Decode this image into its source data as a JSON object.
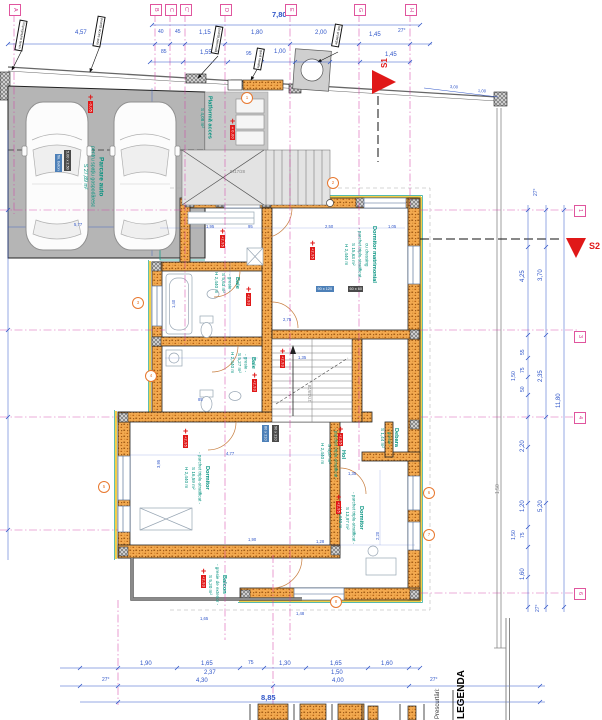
{
  "sections": {
    "s1": "S1",
    "s2": "S2"
  },
  "legend": {
    "title": "LEGENDA",
    "subtitle": "Prescurtări:"
  },
  "grid": {
    "top": [
      {
        "l": "A",
        "x": 14
      },
      {
        "l": "B",
        "x": 155
      },
      {
        "l": "C",
        "x": 170
      },
      {
        "l": "C'",
        "x": 185
      },
      {
        "l": "D",
        "x": 225
      },
      {
        "l": "E",
        "x": 290
      },
      {
        "l": "G",
        "x": 359
      },
      {
        "l": "H",
        "x": 410
      }
    ],
    "right": [
      {
        "l": "1",
        "y": 210
      },
      {
        "l": "3",
        "y": 336
      },
      {
        "l": "4",
        "y": 417
      },
      {
        "l": "6",
        "y": 593
      }
    ]
  },
  "rooms": [
    {
      "n": "master-bedroom",
      "x": 342,
      "y": 226,
      "cls": "",
      "lines": [
        "Dormitor matrimonial",
        "cu dressing",
        "- parchet triplu-stratificat -",
        "S 15,63 m²",
        "H 2,440 m"
      ]
    },
    {
      "n": "bathroom-1",
      "x": 212,
      "y": 272,
      "cls": "",
      "lines": [
        "Baie",
        "- gresie -",
        "S 5,63 m²",
        "H 2,440 m"
      ]
    },
    {
      "n": "bathroom-2",
      "x": 228,
      "y": 352,
      "cls": "",
      "lines": [
        "Baie",
        "- gresie -",
        "S 5,27 m²",
        "H 2,440 m"
      ]
    },
    {
      "n": "bedroom-1",
      "x": 182,
      "y": 452,
      "cls": "",
      "lines": [
        "Dormitor",
        "- parchet triplu-stratificat -",
        "S 16,59 m²",
        "H 2,440 m"
      ]
    },
    {
      "n": "bedroom-2",
      "x": 336,
      "y": 492,
      "cls": "",
      "lines": [
        "Dormitor",
        "- parchet triplu-stratificat -",
        "S 13,97 m²",
        "H 2,440 m"
      ]
    },
    {
      "n": "hallway",
      "x": 318,
      "y": 428,
      "cls": "",
      "lines": [
        "Hol",
        "- parchet triplu-stratificat -",
        "S 4,37 m²",
        "H 2,440 m"
      ]
    },
    {
      "n": "storage",
      "x": 378,
      "y": 428,
      "cls": "",
      "lines": [
        "Debara",
        "- gresie -",
        "S 1,44 m²"
      ]
    },
    {
      "n": "balcony",
      "x": 206,
      "y": 564,
      "cls": "",
      "lines": [
        "Balcon",
        "- gresie de exterior -",
        "S 5,20 m²"
      ]
    },
    {
      "n": "access-platform",
      "x": 198,
      "y": 96,
      "cls": "",
      "lines": [
        "Platformă acces",
        "S 4,08 m²"
      ]
    },
    {
      "n": "parking",
      "x": 80,
      "y": 146,
      "cls": "big",
      "lines": [
        "Parcare auto",
        "pentru spațiu gospodăresc",
        "S 27,89 m²"
      ]
    }
  ],
  "labels": [
    {
      "t": "7,80",
      "x": 272,
      "y": 11,
      "c": "b"
    },
    {
      "t": "4,57",
      "x": 75,
      "y": 30
    },
    {
      "t": "40",
      "x": 158,
      "y": 30,
      "c": "s"
    },
    {
      "t": "45",
      "x": 175,
      "y": 30,
      "c": "s"
    },
    {
      "t": "1,15",
      "x": 199,
      "y": 30
    },
    {
      "t": "1,80",
      "x": 251,
      "y": 30
    },
    {
      "t": "2,00",
      "x": 315,
      "y": 30
    },
    {
      "t": "1,45",
      "x": 369,
      "y": 32
    },
    {
      "t": "27°",
      "x": 398,
      "y": 29,
      "c": "s"
    },
    {
      "t": "85",
      "x": 161,
      "y": 50,
      "c": "s"
    },
    {
      "t": "1,55",
      "x": 200,
      "y": 50
    },
    {
      "t": "95",
      "x": 246,
      "y": 52,
      "c": "s"
    },
    {
      "t": "1,00",
      "x": 274,
      "y": 49
    },
    {
      "t": "1,45",
      "x": 385,
      "y": 52
    },
    {
      "t": "3,00",
      "x": 450,
      "y": 85,
      "c": "xs",
      "r": 4
    },
    {
      "t": "1,00",
      "x": 478,
      "y": 89,
      "c": "xs",
      "r": 4
    },
    {
      "t": "27°",
      "x": 534,
      "y": 196,
      "r": -90,
      "c": "s"
    },
    {
      "t": "3,70",
      "x": 538,
      "y": 281,
      "r": -90
    },
    {
      "t": "4,25",
      "x": 520,
      "y": 282,
      "r": -90
    },
    {
      "t": "55",
      "x": 521,
      "y": 355,
      "r": -90,
      "c": "s"
    },
    {
      "t": "75",
      "x": 521,
      "y": 373,
      "r": -90,
      "c": "s"
    },
    {
      "t": "50",
      "x": 521,
      "y": 392,
      "r": -90,
      "c": "s"
    },
    {
      "t": "1,50",
      "x": 512,
      "y": 381,
      "r": -90,
      "c": "s"
    },
    {
      "t": "2,35",
      "x": 538,
      "y": 382,
      "r": -90
    },
    {
      "t": "11,80",
      "x": 556,
      "y": 408,
      "r": -90
    },
    {
      "t": "2,20",
      "x": 520,
      "y": 452,
      "r": -90
    },
    {
      "t": "5,20",
      "x": 538,
      "y": 512,
      "r": -90
    },
    {
      "t": "1,20",
      "x": 520,
      "y": 512,
      "r": -90
    },
    {
      "t": "75",
      "x": 521,
      "y": 538,
      "r": -90,
      "c": "s"
    },
    {
      "t": "1,50",
      "x": 512,
      "y": 540,
      "r": -90,
      "c": "s"
    },
    {
      "t": "1,60",
      "x": 520,
      "y": 580,
      "r": -90
    },
    {
      "t": "27°",
      "x": 536,
      "y": 612,
      "r": -90,
      "c": "s"
    },
    {
      "t": "1,50",
      "x": 496,
      "y": 494,
      "r": -90,
      "c": "s gray"
    },
    {
      "t": "1,90",
      "x": 140,
      "y": 661
    },
    {
      "t": "1,65",
      "x": 201,
      "y": 661
    },
    {
      "t": "75",
      "x": 248,
      "y": 661,
      "c": "s"
    },
    {
      "t": "1,30",
      "x": 279,
      "y": 661
    },
    {
      "t": "1,65",
      "x": 330,
      "y": 661
    },
    {
      "t": "1,60",
      "x": 381,
      "y": 661
    },
    {
      "t": "2,37",
      "x": 204,
      "y": 670
    },
    {
      "t": "1,50",
      "x": 331,
      "y": 670
    },
    {
      "t": "27°",
      "x": 102,
      "y": 678,
      "c": "s"
    },
    {
      "t": "4,30",
      "x": 196,
      "y": 678
    },
    {
      "t": "4,00",
      "x": 332,
      "y": 678
    },
    {
      "t": "8,85",
      "x": 261,
      "y": 694,
      "c": "b"
    },
    {
      "t": "27°",
      "x": 430,
      "y": 678,
      "c": "s"
    },
    {
      "t": "1,95",
      "x": 206,
      "y": 225,
      "c": "xs"
    },
    {
      "t": "95",
      "x": 248,
      "y": 225,
      "c": "xs"
    },
    {
      "t": "2,50",
      "x": 325,
      "y": 225,
      "c": "xs"
    },
    {
      "t": "1,05",
      "x": 388,
      "y": 225,
      "c": "xs"
    },
    {
      "t": "2,75",
      "x": 283,
      "y": 318,
      "c": "xs"
    },
    {
      "t": "1,35",
      "x": 298,
      "y": 356,
      "c": "xs"
    },
    {
      "t": "85",
      "x": 198,
      "y": 398,
      "c": "xs"
    },
    {
      "t": "4,77",
      "x": 226,
      "y": 452,
      "c": "xs"
    },
    {
      "t": "1,35",
      "x": 348,
      "y": 472,
      "c": "xs"
    },
    {
      "t": "1,90",
      "x": 248,
      "y": 538,
      "c": "xs"
    },
    {
      "t": "1,28",
      "x": 316,
      "y": 540,
      "c": "xs"
    },
    {
      "t": "1,65",
      "x": 200,
      "y": 617,
      "c": "xs"
    },
    {
      "t": "1,48",
      "x": 296,
      "y": 612,
      "c": "xs"
    },
    {
      "t": "1,40",
      "x": 172,
      "y": 308,
      "c": "xs",
      "r": -90
    },
    {
      "t": "3,95",
      "x": 157,
      "y": 468,
      "c": "xs",
      "r": -90
    },
    {
      "t": "2,20",
      "x": 376,
      "y": 540,
      "c": "xs",
      "r": -90
    },
    {
      "t": "5,77",
      "x": 74,
      "y": 223,
      "c": "xs"
    },
    {
      "t": "17x18/28",
      "x": 308,
      "y": 402,
      "c": "xs gray",
      "r": -90
    },
    {
      "t": "9x17/28",
      "x": 230,
      "y": 170,
      "c": "xs gray"
    }
  ],
  "levels": [
    {
      "v": "-0,05",
      "x": 88,
      "y": 94
    },
    {
      "v": "±0,00",
      "x": 230,
      "y": 118
    },
    {
      "v": "+2,95",
      "x": 220,
      "y": 228
    },
    {
      "v": "+2,95",
      "x": 310,
      "y": 240
    },
    {
      "v": "+2,93",
      "x": 246,
      "y": 286
    },
    {
      "v": "+2,93",
      "x": 280,
      "y": 348
    },
    {
      "v": "+2,93",
      "x": 252,
      "y": 372
    },
    {
      "v": "+2,95",
      "x": 183,
      "y": 428
    },
    {
      "v": "+2,95",
      "x": 338,
      "y": 426
    },
    {
      "v": "+2,95",
      "x": 336,
      "y": 494
    },
    {
      "v": "+2,93",
      "x": 201,
      "y": 568
    }
  ],
  "circles": [
    {
      "n": "1",
      "x": 241,
      "y": 92
    },
    {
      "n": "2",
      "x": 327,
      "y": 177
    },
    {
      "n": "3",
      "x": 132,
      "y": 297
    },
    {
      "n": "4",
      "x": 145,
      "y": 370
    },
    {
      "n": "5",
      "x": 98,
      "y": 481
    },
    {
      "n": "6",
      "x": 423,
      "y": 487
    },
    {
      "n": "7",
      "x": 423,
      "y": 529
    },
    {
      "n": "8",
      "x": 330,
      "y": 596
    }
  ],
  "callouts": [
    {
      "t": "împrejmuire teren",
      "x": 17,
      "y": 20,
      "r": 10
    },
    {
      "t": "poartă acces auto",
      "x": 95,
      "y": 16,
      "r": 10
    },
    {
      "t": "poartă pietonală",
      "x": 213,
      "y": 26,
      "r": 10
    },
    {
      "t": "gard metalic",
      "x": 255,
      "y": 48,
      "r": 10
    },
    {
      "t": "tub protecție",
      "x": 333,
      "y": 24,
      "r": 10
    }
  ],
  "tags": [
    {
      "t": "90 x 120",
      "x": 316,
      "y": 286,
      "bg": "blue",
      "v": 0
    },
    {
      "t": "60 x 60",
      "x": 348,
      "y": 286,
      "bg": "dark",
      "v": 0
    },
    {
      "t": "80 x 210",
      "x": 262,
      "y": 425,
      "bg": "blue",
      "v": 1
    },
    {
      "t": "90 x 210",
      "x": 272,
      "y": 425,
      "bg": "dark",
      "v": 1
    },
    {
      "t": "5,00 x 2,50",
      "x": 64,
      "y": 150,
      "bg": "dark",
      "v": 1
    },
    {
      "t": "fin. beton",
      "x": 55,
      "y": 154,
      "bg": "blue",
      "v": 1
    }
  ]
}
